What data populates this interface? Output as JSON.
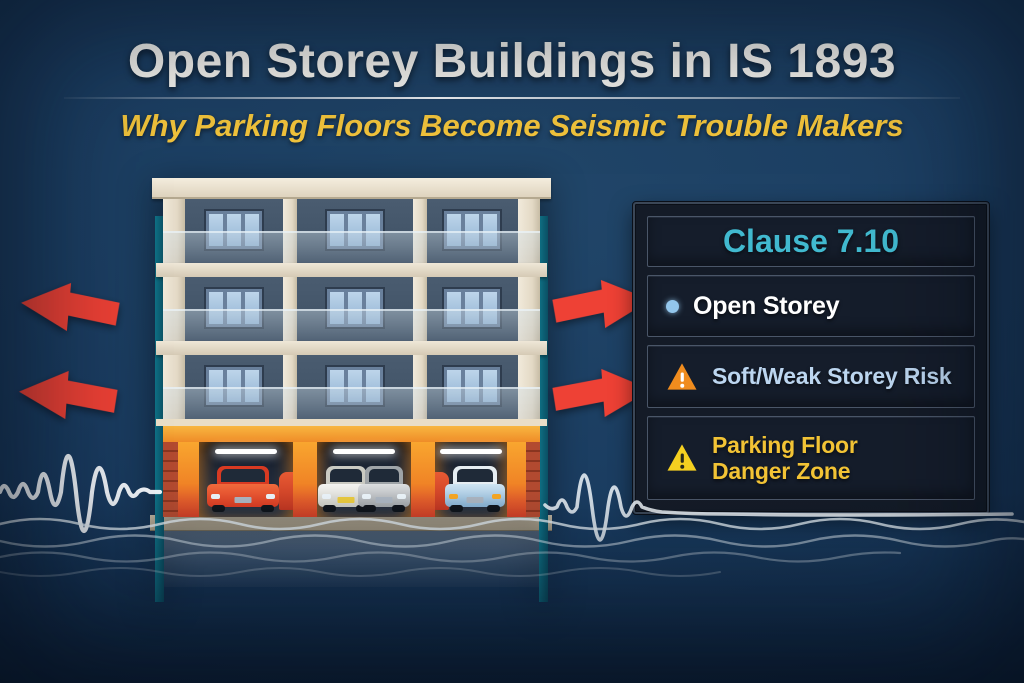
{
  "header": {
    "title": "Open Storey Buildings in IS 1893",
    "subtitle": "Why Parking Floors Become Seismic Trouble Makers"
  },
  "panel": {
    "title": "Clause 7.10",
    "items": [
      {
        "icon": "bullet",
        "label": "Open Storey"
      },
      {
        "icon": "warning-triangle-orange",
        "label": "Soft/Weak Storey Risk"
      },
      {
        "icon": "warning-triangle-yellow",
        "label": "Parking Floor Danger Zone"
      }
    ]
  },
  "building": {
    "storeys_above_parking": 3,
    "bays_per_storey": 3,
    "parking": {
      "cars": [
        "red",
        "white",
        "silver",
        "blue"
      ],
      "ceiling_lights": 3
    }
  },
  "decor": {
    "red_arrows": [
      "left-top",
      "left-bottom",
      "right-top",
      "right-bottom"
    ],
    "seismic_waveforms": [
      "left",
      "right"
    ],
    "ground_waves": true
  },
  "colors": {
    "background_navy": "#1a3c60",
    "title_text": "#f7f6f1",
    "subtitle_yellow": "#f2c43c",
    "clause_cyan": "#41b9cf",
    "risk_text_blue": "#bcd6f0",
    "danger_text_yellow": "#f2c335",
    "arrow_red": "#ee4135",
    "parking_orange": "#f08426",
    "panel_background": "#141b27"
  }
}
